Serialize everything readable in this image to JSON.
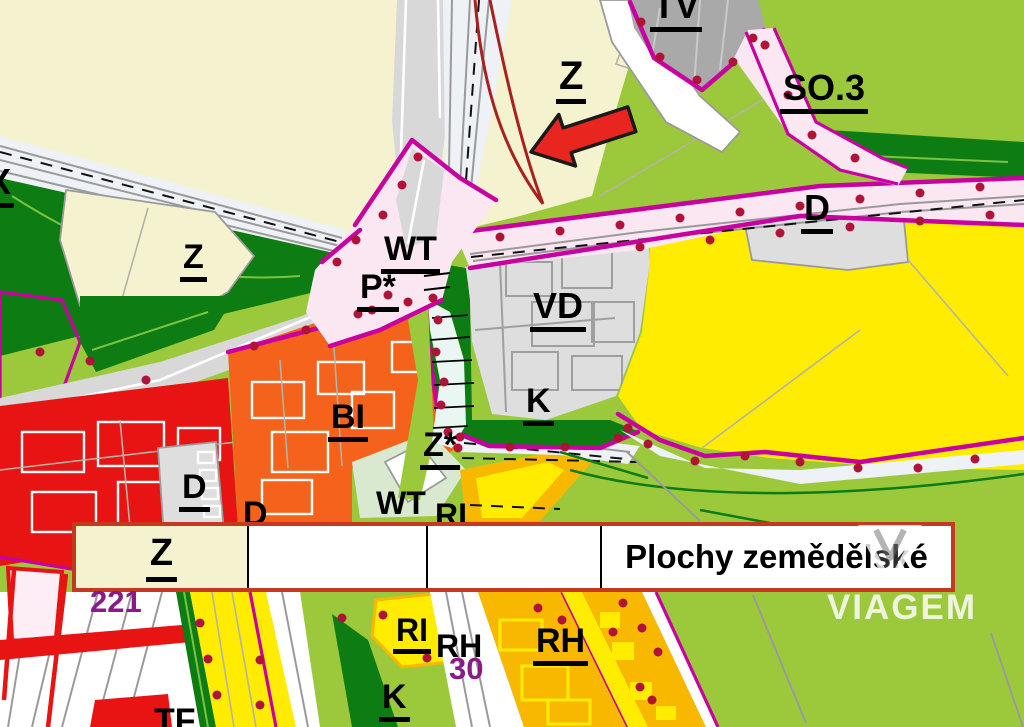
{
  "legend": {
    "cells": [
      "Z",
      "",
      "",
      "Plochy zemědělské"
    ]
  },
  "watermark": {
    "text": "VIAGEM"
  },
  "labels": [
    {
      "text": "TV"
    },
    {
      "text": "Z"
    },
    {
      "text": "SO.3"
    },
    {
      "text": "D"
    },
    {
      "text": "X"
    },
    {
      "text": "Z"
    },
    {
      "text": "WT"
    },
    {
      "text": "P*"
    },
    {
      "text": "VD"
    },
    {
      "text": "K"
    },
    {
      "text": "BI"
    },
    {
      "text": "Z*"
    },
    {
      "text": "D"
    },
    {
      "text": "D"
    },
    {
      "text": "WT"
    },
    {
      "text": "RI"
    },
    {
      "text": "221"
    },
    {
      "text": "RI"
    },
    {
      "text": "RH"
    },
    {
      "text": "30"
    },
    {
      "text": "RH"
    },
    {
      "text": "K"
    },
    {
      "text": "TF"
    }
  ],
  "zone_colors": {
    "cream": "#f5f2d0",
    "lgreen": "#9cc93c",
    "dgreen": "#0d7c12",
    "yellow": "#ffec00",
    "amber": "#f8b800",
    "orange": "#f4621b",
    "red": "#e81414",
    "magenta": "#c800a0",
    "dot": "#b01238",
    "pink": "#fae7f1",
    "road": "#d8d8d8",
    "vdgray": "#dedede",
    "tvgray": "#a9a9a9",
    "stream": "#e9f6f2",
    "rail": "#eef2f6",
    "maroon": "#a82020",
    "arrow": "#e8251f",
    "legend_border": "#c43a20",
    "purple": "#8a1a8a",
    "white": "#ffffff",
    "gray_line": "#9a9a9a",
    "green_line": "#7cc142",
    "palegreen": "#d9e9cf",
    "pale_pink": "#fdeef5"
  }
}
